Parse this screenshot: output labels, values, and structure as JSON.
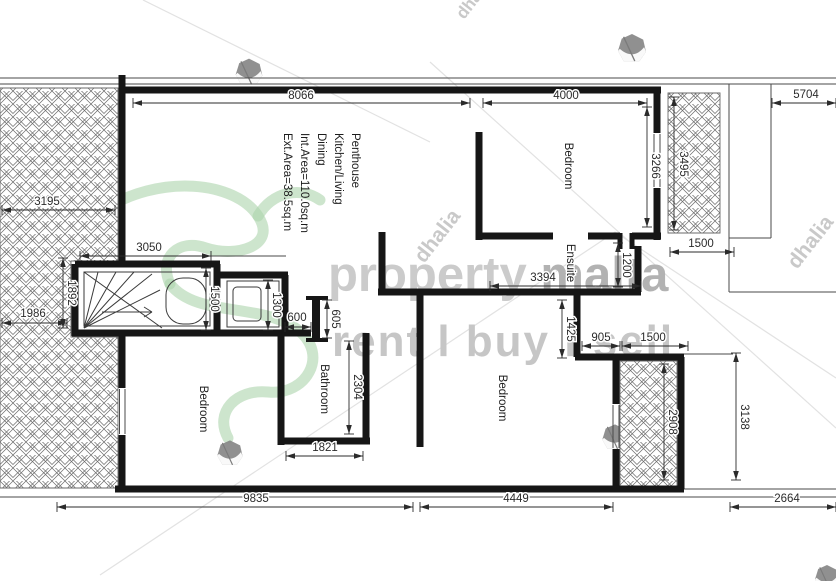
{
  "document": {
    "type_label": "penthouse-floor-plan",
    "background": "#ffffff",
    "wall_color": "#161616",
    "thin_color": "#4a4a4a",
    "dim_color": "#2b2b2b",
    "hatch_color": "#6a6a6a",
    "green_accent": "#abd4ab",
    "gray_light": "#cbcbcb",
    "gray_mid": "#b2b2b2"
  },
  "watermark": {
    "brand_light": "property",
    "brand_dark": "malta",
    "tagline": "rent l buy l sell",
    "agency": "dhalia",
    "marks": [
      {
        "x": 26,
        "y": 300,
        "size": 27,
        "rot": -52
      },
      {
        "x": 424,
        "y": 264,
        "size": 21,
        "rot": -52
      },
      {
        "x": 797,
        "y": 270,
        "size": 21,
        "rot": -52
      },
      {
        "x": 464,
        "y": 20,
        "size": 17,
        "rot": -52
      }
    ],
    "gems": [
      {
        "x": 249,
        "y": 72,
        "s": 1.0
      },
      {
        "x": 632,
        "y": 48,
        "s": 1.05
      },
      {
        "x": 230,
        "y": 453,
        "s": 0.95
      },
      {
        "x": 615,
        "y": 437,
        "s": 0.95
      },
      {
        "x": 827,
        "y": 577,
        "s": 0.9
      }
    ],
    "faint_lines": [
      [
        100,
        575,
        615,
        232
      ],
      [
        615,
        232,
        836,
        378
      ],
      [
        430,
        62,
        836,
        428
      ],
      [
        143,
        0,
        430,
        142
      ]
    ]
  },
  "penthouse_text": {
    "lines": [
      "Penthouse",
      "Kitchen/Living",
      "Dining",
      "Int.Area=110.0sq.m",
      "Ext.Area=38.5sq.m"
    ],
    "x_start": 352,
    "y": 133,
    "spacing": 17,
    "font_size": 11.5
  },
  "room_labels": [
    {
      "text": "Bedroom",
      "x": 565,
      "y": 166
    },
    {
      "text": "Ensuite",
      "x": 567,
      "y": 263
    },
    {
      "text": "Bedroom",
      "x": 499,
      "y": 398
    },
    {
      "text": "Bathroom",
      "x": 321,
      "y": 389
    },
    {
      "text": "Bedroom",
      "x": 200,
      "y": 409
    }
  ],
  "dimensions": [
    {
      "label": "8066",
      "x1": 133,
      "y1": 103,
      "x2": 470,
      "y2": 103,
      "tx": 301,
      "ty": 99,
      "vert": false
    },
    {
      "label": "4000",
      "x1": 483,
      "y1": 103,
      "x2": 647,
      "y2": 103,
      "tx": 566,
      "ty": 99,
      "vert": false
    },
    {
      "label": "5704",
      "x1": 772,
      "y1": 103,
      "x2": 836,
      "y2": 103,
      "tx": 806,
      "ty": 98,
      "vert": false
    },
    {
      "label": "3195",
      "x1": 2,
      "y1": 210,
      "x2": 115,
      "y2": 210,
      "tx": 47,
      "ty": 205,
      "vert": false
    },
    {
      "label": "3050",
      "x1": 80,
      "y1": 256,
      "x2": 211,
      "y2": 256,
      "tx": 149,
      "ty": 251,
      "vert": false
    },
    {
      "label": "1500",
      "x1": 670,
      "y1": 252,
      "x2": 734,
      "y2": 252,
      "tx": 701,
      "ty": 247,
      "vert": false
    },
    {
      "label": "3394",
      "x1": 490,
      "y1": 286,
      "x2": 641,
      "y2": 286,
      "tx": 543,
      "ty": 281,
      "vert": false
    },
    {
      "label": "1986",
      "x1": 2,
      "y1": 323,
      "x2": 67,
      "y2": 323,
      "tx": 33,
      "ty": 317,
      "vert": false
    },
    {
      "label": "600",
      "x1": 285,
      "y1": 327,
      "x2": 311,
      "y2": 327,
      "tx": 297,
      "ty": 321,
      "vert": false
    },
    {
      "label": "905",
      "x1": 582,
      "y1": 346,
      "x2": 620,
      "y2": 346,
      "tx": 601,
      "ty": 341,
      "vert": false
    },
    {
      "label": "1500",
      "x1": 622,
      "y1": 346,
      "x2": 688,
      "y2": 346,
      "tx": 653,
      "ty": 341,
      "vert": false
    },
    {
      "label": "1821",
      "x1": 286,
      "y1": 456,
      "x2": 363,
      "y2": 456,
      "tx": 325,
      "ty": 451,
      "vert": false
    },
    {
      "label": "9835",
      "x1": 57,
      "y1": 507,
      "x2": 413,
      "y2": 507,
      "tx": 256,
      "ty": 502,
      "vert": false
    },
    {
      "label": "4449",
      "x1": 420,
      "y1": 507,
      "x2": 613,
      "y2": 507,
      "tx": 516,
      "ty": 502,
      "vert": false
    },
    {
      "label": "2664",
      "x1": 730,
      "y1": 507,
      "x2": 836,
      "y2": 507,
      "tx": 787,
      "ty": 502,
      "vert": false
    },
    {
      "label": "3266",
      "x1": 647,
      "y1": 107,
      "x2": 647,
      "y2": 227,
      "tx": 652,
      "ty": 166,
      "vert": true
    },
    {
      "label": "3495",
      "x1": 674,
      "y1": 97,
      "x2": 674,
      "y2": 230,
      "tx": 680,
      "ty": 164,
      "vert": true
    },
    {
      "label": "1892",
      "x1": 63,
      "y1": 258,
      "x2": 63,
      "y2": 328,
      "tx": 68,
      "ty": 293,
      "vert": true
    },
    {
      "label": "1500",
      "x1": 206,
      "y1": 268,
      "x2": 206,
      "y2": 330,
      "tx": 211,
      "ty": 299,
      "vert": true
    },
    {
      "label": "1300",
      "x1": 268,
      "y1": 280,
      "x2": 268,
      "y2": 330,
      "tx": 273,
      "ty": 305,
      "vert": true
    },
    {
      "label": "605",
      "x1": 327,
      "y1": 300,
      "x2": 327,
      "y2": 338,
      "tx": 332,
      "ty": 319,
      "vert": true
    },
    {
      "label": "1200",
      "x1": 618,
      "y1": 243,
      "x2": 618,
      "y2": 287,
      "tx": 623,
      "ty": 265,
      "vert": true
    },
    {
      "label": "1425",
      "x1": 562,
      "y1": 300,
      "x2": 562,
      "y2": 358,
      "tx": 567,
      "ty": 329,
      "vert": true
    },
    {
      "label": "2304",
      "x1": 349,
      "y1": 341,
      "x2": 349,
      "y2": 434,
      "tx": 354,
      "ty": 387,
      "vert": true
    },
    {
      "label": "2908",
      "x1": 664,
      "y1": 364,
      "x2": 664,
      "y2": 480,
      "tx": 669,
      "ty": 422,
      "vert": true
    },
    {
      "label": "3138",
      "x1": 736,
      "y1": 353,
      "x2": 736,
      "y2": 480,
      "tx": 741,
      "ty": 417,
      "vert": true
    }
  ],
  "floorplan": {
    "walls": [
      [
        122,
        75,
        122,
        264
      ],
      [
        119,
        90,
        661,
        90
      ],
      [
        657,
        90,
        657,
        133
      ],
      [
        657,
        188,
        657,
        240
      ],
      [
        479,
        132,
        479,
        240
      ],
      [
        476,
        236,
        553,
        236
      ],
      [
        588,
        236,
        620,
        236
      ],
      [
        632,
        236,
        661,
        236
      ],
      [
        620,
        233,
        620,
        249,
        5
      ],
      [
        632,
        233,
        632,
        249,
        5
      ],
      [
        638,
        246,
        638,
        292
      ],
      [
        378,
        292,
        641,
        292
      ],
      [
        382,
        232,
        382,
        295
      ],
      [
        420,
        292,
        420,
        447
      ],
      [
        577,
        292,
        577,
        357
      ],
      [
        575,
        357,
        622,
        357
      ],
      [
        616,
        357,
        616,
        404
      ],
      [
        616,
        449,
        616,
        491
      ],
      [
        618,
        357,
        684,
        357
      ],
      [
        681,
        357,
        681,
        489
      ],
      [
        115,
        489,
        684,
        489
      ],
      [
        122,
        333,
        122,
        388
      ],
      [
        122,
        435,
        122,
        489
      ],
      [
        75,
        264,
        220,
        264
      ],
      [
        75,
        264,
        75,
        336
      ],
      [
        72,
        333,
        311,
        333
      ],
      [
        217,
        264,
        217,
        333
      ],
      [
        217,
        275,
        288,
        275
      ],
      [
        285,
        275,
        285,
        333
      ],
      [
        316,
        296,
        316,
        342,
        8
      ],
      [
        306,
        298,
        328,
        298,
        4
      ],
      [
        306,
        340,
        328,
        340,
        4
      ],
      [
        281,
        333,
        281,
        445
      ],
      [
        278,
        441,
        370,
        441
      ],
      [
        366,
        333,
        366,
        441
      ]
    ],
    "thin_lines": [
      [
        0,
        78,
        836,
        78
      ],
      [
        0,
        84,
        836,
        84
      ],
      [
        729,
        84,
        729,
        292
      ],
      [
        729,
        292,
        836,
        292
      ],
      [
        771,
        84,
        771,
        238
      ],
      [
        729,
        238,
        771,
        238
      ],
      [
        684,
        354,
        733,
        354
      ],
      [
        684,
        489,
        836,
        489
      ],
      [
        0,
        497,
        836,
        497
      ],
      [
        211,
        256,
        286,
        256
      ],
      [
        119.5,
        389,
        119.5,
        434
      ],
      [
        125,
        389,
        125,
        434
      ],
      [
        654,
        134,
        654,
        187
      ],
      [
        660,
        134,
        660,
        187
      ],
      [
        613,
        405,
        613,
        448
      ],
      [
        619,
        405,
        619,
        448
      ]
    ],
    "hatch_paths": [
      "M0,88 H118 V261 H71 V337 H118 V488 H0 Z",
      "M668,93 H720 V233 H668 Z",
      "M620,361 H677 V487 H620 Z"
    ],
    "details": [
      {
        "type": "rect",
        "x": 84,
        "y": 272,
        "w": 126,
        "h": 54
      },
      {
        "type": "path",
        "d": "M84,328 L98,272 M84,328 L116,272 M84,328 L134,272 M84,328 L152,274 M84,328 L160,290 M84,272 L162,328"
      },
      {
        "type": "path",
        "d": "M102,312 L152,312 M152,312 L144,307 M152,312 L144,317"
      },
      {
        "type": "rect",
        "x": 166,
        "y": 278,
        "w": 40,
        "h": 46,
        "rx": 17
      },
      {
        "type": "rect",
        "x": 227,
        "y": 281,
        "w": 52,
        "h": 46
      },
      {
        "type": "rect",
        "x": 233,
        "y": 287,
        "w": 28,
        "h": 34,
        "rx": 4
      }
    ],
    "gecko_paths": [
      "M100,212 C160,172 236,182 258,216 C278,246 236,258 206,248 C178,238 158,258 170,284",
      "M170,284 C196,318 262,302 298,330 C330,355 306,396 268,392 C236,389 214,412 228,438",
      "M258,216 C272,192 300,186 320,200"
    ]
  }
}
